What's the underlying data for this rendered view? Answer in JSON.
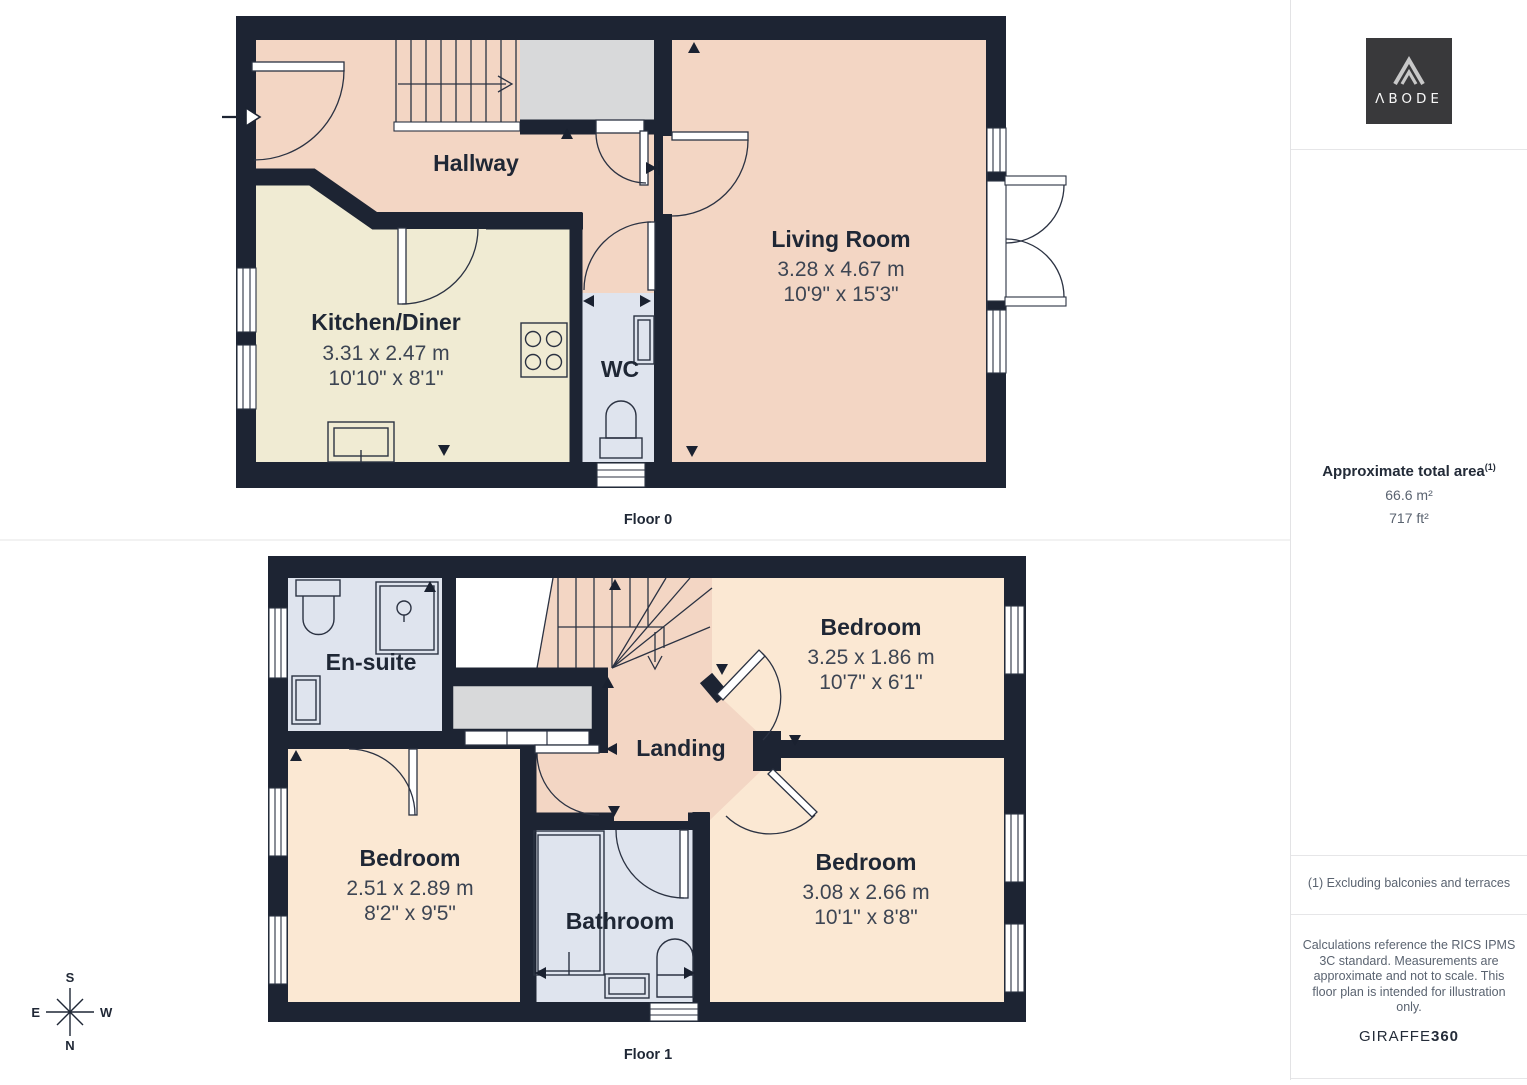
{
  "branding": {
    "logo_text": "ΛBODE",
    "vendor_name": "GIRAFFE",
    "vendor_suffix": "360"
  },
  "sidebar": {
    "area_title": "Approximate total area",
    "area_marker": "(1)",
    "area_metric": "66.6 m²",
    "area_imperial": "717 ft²",
    "footnote": "(1) Excluding balconies and terraces",
    "disclaimer": "Calculations reference the RICS IPMS 3C standard. Measurements are approximate and not to scale. This floor plan is intended for illustration only."
  },
  "floors": [
    {
      "label": "Floor 0",
      "rooms": {
        "hallway": {
          "name": "Hallway"
        },
        "kitchen": {
          "name": "Kitchen/Diner",
          "metric": "3.31 x 2.47 m",
          "imperial": "10'10\" x 8'1\""
        },
        "wc": {
          "name": "WC"
        },
        "living_room": {
          "name": "Living Room",
          "metric": "3.28 x 4.67 m",
          "imperial": "10'9\" x 15'3\""
        }
      }
    },
    {
      "label": "Floor 1",
      "rooms": {
        "ensuite": {
          "name": "En-suite"
        },
        "bedroom_top_right": {
          "name": "Bedroom",
          "metric": "3.25 x 1.86 m",
          "imperial": "10'7\" x 6'1\""
        },
        "landing": {
          "name": "Landing"
        },
        "bedroom_left": {
          "name": "Bedroom",
          "metric": "2.51 x 2.89 m",
          "imperial": "8'2\" x 9'5\""
        },
        "bathroom": {
          "name": "Bathroom"
        },
        "bedroom_bottom_right": {
          "name": "Bedroom",
          "metric": "3.08 x 2.66 m",
          "imperial": "10'1\" x 8'8\""
        }
      }
    }
  ],
  "compass": {
    "north": "N",
    "south": "S",
    "east": "E",
    "west": "W"
  },
  "colors": {
    "wall": "#1d2433",
    "hall_salmon": "#f3d6c4",
    "kitchen_cream": "#f0ebd3",
    "wet_room_blue": "#dfe4ee",
    "bedroom_peach": "#fbe8d3",
    "void_gray": "#d8d9da",
    "logo_bg": "#39393b"
  }
}
